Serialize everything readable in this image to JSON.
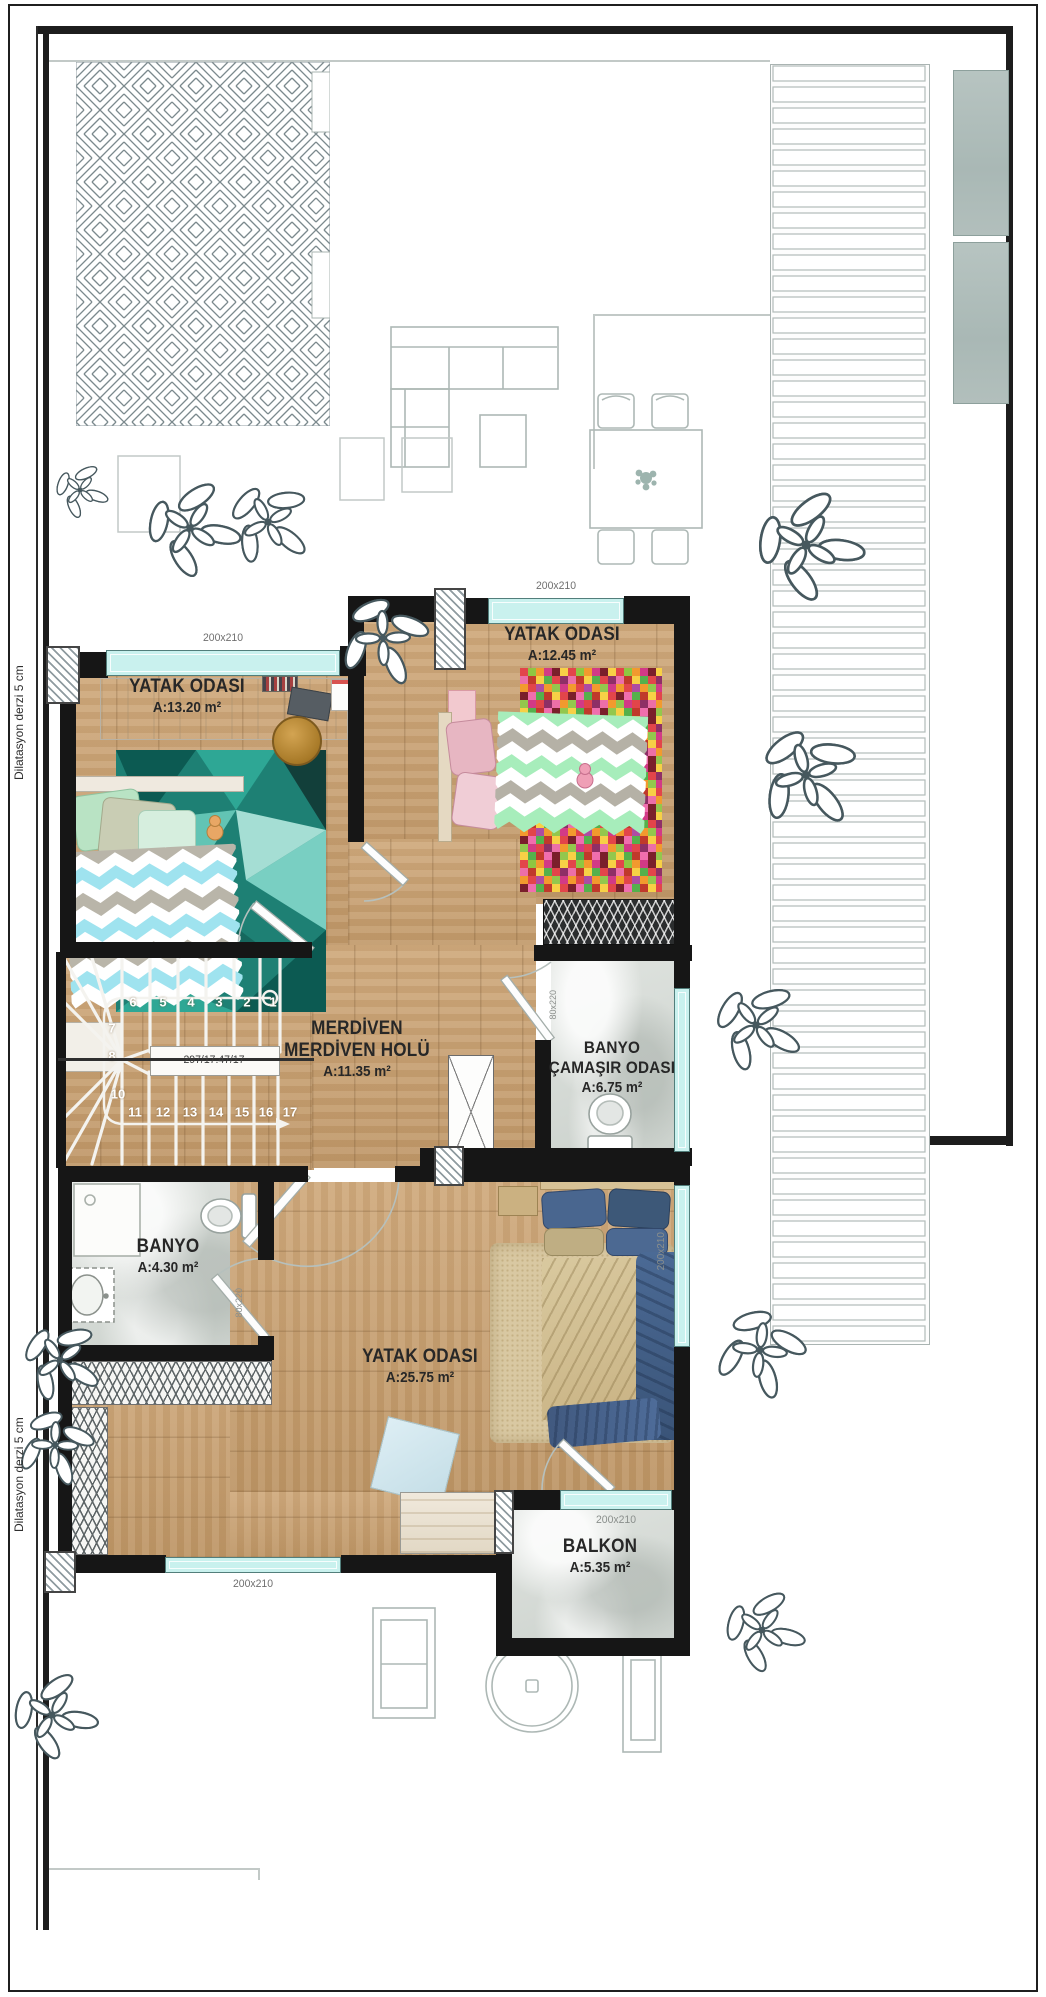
{
  "plan": {
    "rooms": [
      {
        "name": "YATAK ODASI",
        "area": "A:13.20 m²"
      },
      {
        "name": "YATAK ODASI",
        "area": "A:12.45 m²"
      },
      {
        "name": "MERDİVEN",
        "name2": "MERDİVEN HOLÜ",
        "area": "A:11.35 m²"
      },
      {
        "name": "BANYO",
        "name2": "ÇAMAŞIR ODASI",
        "area": "A:6.75 m²"
      },
      {
        "name": "BANYO",
        "area": "A:4.30 m²"
      },
      {
        "name": "YATAK ODASI",
        "area": "A:25.75 m²"
      },
      {
        "name": "BALKON",
        "area": "A:5.35 m²"
      }
    ],
    "window_size_label": "200x210",
    "door_size_label": "80x220",
    "stairs": {
      "dimension": "297/17.47/17",
      "numbers": [
        "1",
        "2",
        "3",
        "4",
        "5",
        "6",
        "7",
        "8",
        "9",
        "10",
        "11",
        "12",
        "13",
        "14",
        "15",
        "16",
        "17"
      ]
    },
    "expansion_joint_note": "Dilatasyon derzi 5 cm",
    "colors": {
      "wall": "#161616",
      "window_glass": "#c9f1ee",
      "wood_floor": "#c9a173",
      "marble_floor": "#d8dcd8",
      "tree": "#46585e",
      "rug_teal": "#1e8074"
    }
  }
}
